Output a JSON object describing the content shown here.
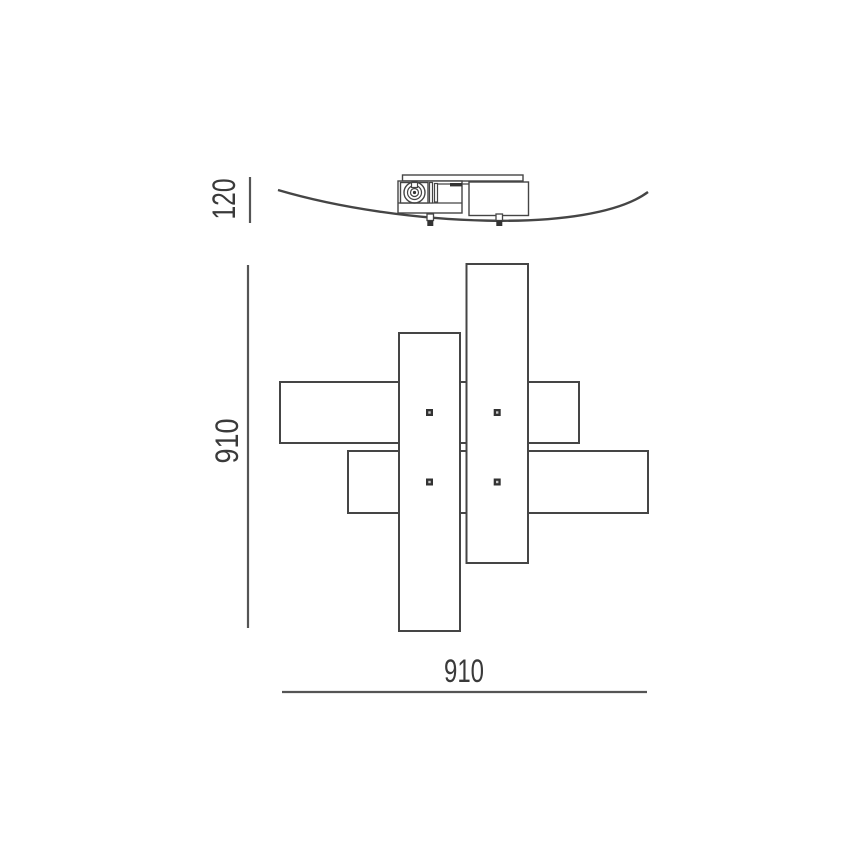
{
  "palette": {
    "background": "#ffffff",
    "line": "#454545",
    "dimension_line": "#555555",
    "text": "#3a3a3a",
    "dark_fill": "#333333",
    "screw_center": "#c8c8c8"
  },
  "dimensions": {
    "side_height_label": "120",
    "plan_height_label": "910",
    "plan_width_label": "910"
  },
  "views": {
    "side_view_parts": [
      "glass-diffuser-curve",
      "canopy-lid",
      "canopy-body",
      "cable-gland",
      "mounting-clips"
    ],
    "plan_view_parts": [
      "glass-panel-top-horizontal",
      "glass-panel-bottom-horizontal",
      "glass-panel-left-vertical",
      "glass-panel-right-vertical",
      "fixing-screws"
    ]
  }
}
